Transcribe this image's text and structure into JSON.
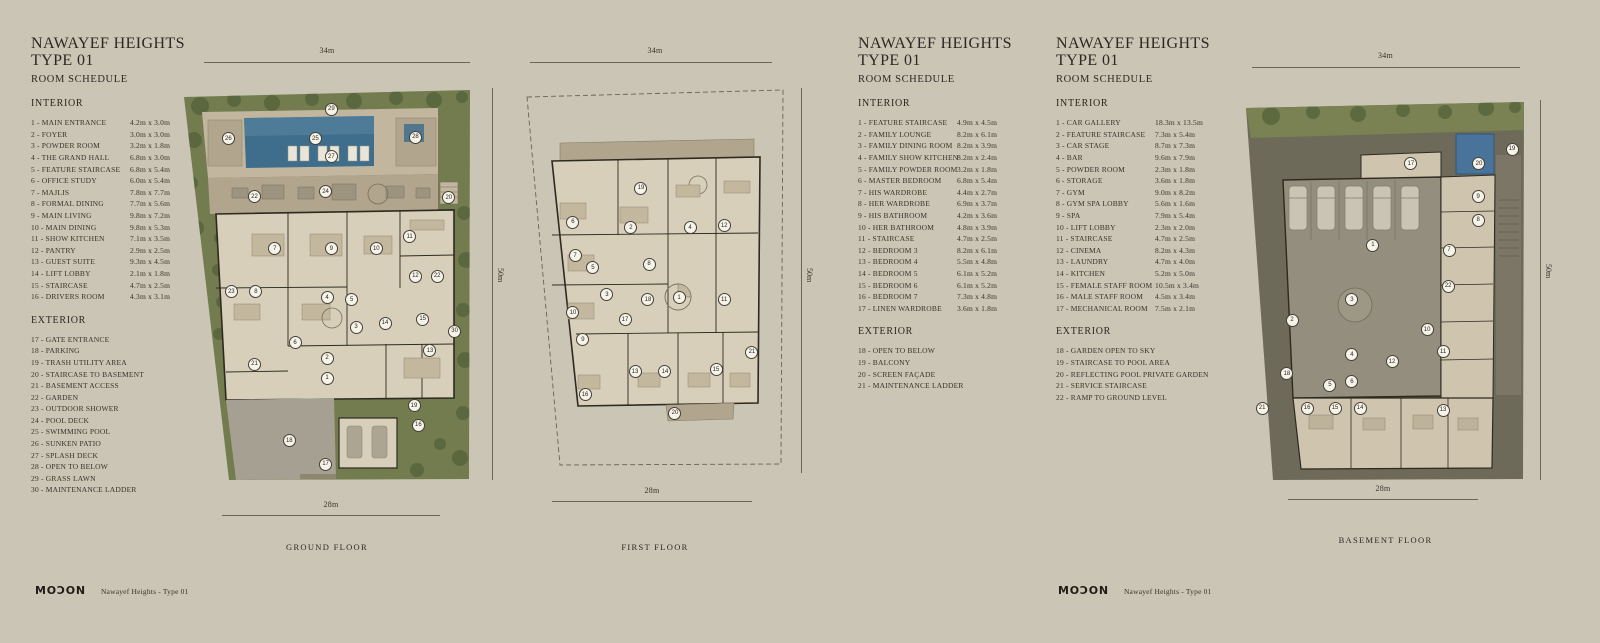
{
  "colors": {
    "bg": "#cbc5b6",
    "ink": "#38332a",
    "land": "#727c4f",
    "tree": "#5a673e",
    "pool": "#3f6e8d",
    "deck": "#c2b69e",
    "terrace": "#b1a58d",
    "floor": "#d8cfba",
    "wall": "#2e2a21",
    "drive": "#a6a092",
    "earth": "#6e6a59",
    "roomtan": "#cfc5ae",
    "paper": "#f6f3e9"
  },
  "sheet_title": {
    "line1": "NAWAYEF HEIGHTS",
    "line2": "TYPE 01",
    "line3": "ROOM SCHEDULE"
  },
  "schedules": [
    {
      "interior_heading": "INTERIOR",
      "exterior_heading": "EXTERIOR",
      "interior": [
        {
          "label": "1 - MAIN ENTRANCE",
          "dim": "4.2m x 3.0m"
        },
        {
          "label": "2 - FOYER",
          "dim": "3.0m x 3.0m"
        },
        {
          "label": "3 - POWDER ROOM",
          "dim": "3.2m x 1.8m"
        },
        {
          "label": "4 - THE GRAND HALL",
          "dim": "6.8m x 3.0m"
        },
        {
          "label": "5 - FEATURE STAIRCASE",
          "dim": "6.8m x 5.4m"
        },
        {
          "label": "6 - OFFICE STUDY",
          "dim": "6.0m x 5.4m"
        },
        {
          "label": "7 - MAJLIS",
          "dim": "7.8m x 7.7m"
        },
        {
          "label": "8 - FORMAL DINING",
          "dim": "7.7m x 5.6m"
        },
        {
          "label": "9 - MAIN LIVING",
          "dim": "9.8m x 7.2m"
        },
        {
          "label": "10 - MAIN DINING",
          "dim": "9.8m x 5.3m"
        },
        {
          "label": "11 - SHOW KITCHEN",
          "dim": "7.1m x 3.5m"
        },
        {
          "label": "12 - PANTRY",
          "dim": "2.9m x 2.5m"
        },
        {
          "label": "13 - GUEST SUITE",
          "dim": "9.3m x 4.5m"
        },
        {
          "label": "14 - LIFT LOBBY",
          "dim": "2.1m x 1.8m"
        },
        {
          "label": "15 - STAIRCASE",
          "dim": "4.7m x 2.5m"
        },
        {
          "label": "16 - DRIVERS ROOM",
          "dim": "4.3m x 3.1m"
        }
      ],
      "exterior": [
        {
          "label": "17 - GATE ENTRANCE"
        },
        {
          "label": "18 - PARKING"
        },
        {
          "label": "19 - TRASH UTILITY AREA"
        },
        {
          "label": "20 - STAIRCASE TO BASEMENT"
        },
        {
          "label": "21 - BASEMENT ACCESS"
        },
        {
          "label": "22 - GARDEN"
        },
        {
          "label": "23 - OUTDOOR SHOWER"
        },
        {
          "label": "24 - POOL DECK"
        },
        {
          "label": "25 - SWIMMING POOL"
        },
        {
          "label": "26 - SUNKEN PATIO"
        },
        {
          "label": "27 - SPLASH DECK"
        },
        {
          "label": "28 - OPEN TO BELOW"
        },
        {
          "label": "29 - GRASS LAWN"
        },
        {
          "label": "30 - MAINTENANCE LADDER"
        }
      ]
    },
    {
      "interior_heading": "INTERIOR",
      "exterior_heading": "EXTERIOR",
      "interior": [
        {
          "label": "1 - FEATURE STAIRCASE",
          "dim": "4.9m x 4.5m"
        },
        {
          "label": "2 - FAMILY LOUNGE",
          "dim": "8.2m x 6.1m"
        },
        {
          "label": "3 - FAMILY DINING ROOM",
          "dim": "8.2m x 3.9m"
        },
        {
          "label": "4 - FAMILY SHOW KITCHEN",
          "dim": "8.2m x 2.4m"
        },
        {
          "label": "5 - FAMILY POWDER ROOM",
          "dim": "3.2m x 1.8m"
        },
        {
          "label": "6 - MASTER BEDROOM",
          "dim": "6.8m x 5.4m"
        },
        {
          "label": "7 - HIS WARDROBE",
          "dim": "4.4m x 2.7m"
        },
        {
          "label": "8 - HER WARDROBE",
          "dim": "6.9m x 3.7m"
        },
        {
          "label": "9 - HIS BATHROOM",
          "dim": "4.2m x 3.6m"
        },
        {
          "label": "10 - HER BATHROOM",
          "dim": "4.8m x 3.9m"
        },
        {
          "label": "11 - STAIRCASE",
          "dim": "4.7m x 2.5m"
        },
        {
          "label": "12 - BEDROOM 3",
          "dim": "8.2m x 6.1m"
        },
        {
          "label": "13 - BEDROOM 4",
          "dim": "5.5m x 4.8m"
        },
        {
          "label": "14 - BEDROOM 5",
          "dim": "6.1m x 5.2m"
        },
        {
          "label": "15 - BEDROOM 6",
          "dim": "6.1m x 5.2m"
        },
        {
          "label": "16 - BEDROOM 7",
          "dim": "7.3m x 4.8m"
        },
        {
          "label": "17 - LINEN WARDROBE",
          "dim": "3.6m x 1.8m"
        }
      ],
      "exterior": [
        {
          "label": "18 - OPEN TO BELOW"
        },
        {
          "label": "19 - BALCONY"
        },
        {
          "label": "20 - SCREEN FAÇADE"
        },
        {
          "label": "21 - MAINTENANCE LADDER"
        }
      ]
    },
    {
      "interior_heading": "INTERIOR",
      "exterior_heading": "EXTERIOR",
      "interior": [
        {
          "label": "1 - CAR GALLERY",
          "dim": "18.3m x 13.5m"
        },
        {
          "label": "2 - FEATURE STAIRCASE",
          "dim": "7.3m x 5.4m"
        },
        {
          "label": "3 - CAR STAGE",
          "dim": "8.7m x 7.3m"
        },
        {
          "label": "4 - BAR",
          "dim": "9.6m x 7.9m"
        },
        {
          "label": "5 - POWDER ROOM",
          "dim": "2.3m x 1.8m"
        },
        {
          "label": "6 - STORAGE",
          "dim": "3.6m x 1.8m"
        },
        {
          "label": "7 - GYM",
          "dim": "9.0m x 8.2m"
        },
        {
          "label": "8 - GYM SPA LOBBY",
          "dim": "5.6m x 1.6m"
        },
        {
          "label": "9 - SPA",
          "dim": "7.9m x 5.4m"
        },
        {
          "label": "10 - LIFT LOBBY",
          "dim": "2.3m x 2.0m"
        },
        {
          "label": "11 - STAIRCASE",
          "dim": "4.7m x 2.5m"
        },
        {
          "label": "12 - CINEMA",
          "dim": "8.2m x 4.3m"
        },
        {
          "label": "13 - LAUNDRY",
          "dim": "4.7m x 4.0m"
        },
        {
          "label": "14 - KITCHEN",
          "dim": "5.2m x 5.0m"
        },
        {
          "label": "15 - FEMALE STAFF ROOM",
          "dim": "10.5m x 3.4m"
        },
        {
          "label": "16 - MALE STAFF ROOM",
          "dim": "4.5m x 3.4m"
        },
        {
          "label": "17 - MECHANICAL ROOM",
          "dim": "7.5m x 2.1m"
        }
      ],
      "exterior": [
        {
          "label": "18 - GARDEN OPEN TO SKY"
        },
        {
          "label": "19 - STAIRCASE TO POOL AREA"
        },
        {
          "label": "20 - REFLECTING POOL PRIVATE GARDEN"
        },
        {
          "label": "21 - SERVICE STAIRCASE"
        },
        {
          "label": "22 - RAMP TO GROUND LEVEL"
        }
      ]
    }
  ],
  "plans": [
    {
      "caption": "GROUND FLOOR",
      "dim_top": "34m",
      "dim_bottom": "28m",
      "dim_right": "50m",
      "markers": [
        {
          "n": 29,
          "x": 51.5,
          "y": 5.4
        },
        {
          "n": 26,
          "x": 16,
          "y": 13
        },
        {
          "n": 25,
          "x": 46,
          "y": 13
        },
        {
          "n": 27,
          "x": 51.5,
          "y": 17.6
        },
        {
          "n": 28,
          "x": 80.5,
          "y": 12.5
        },
        {
          "n": 22,
          "x": 25,
          "y": 27.8
        },
        {
          "n": 24,
          "x": 49.5,
          "y": 26.5
        },
        {
          "n": 20,
          "x": 92,
          "y": 28
        },
        {
          "n": 7,
          "x": 32,
          "y": 41
        },
        {
          "n": 9,
          "x": 51.5,
          "y": 41
        },
        {
          "n": 10,
          "x": 67,
          "y": 41
        },
        {
          "n": 11,
          "x": 78.5,
          "y": 38
        },
        {
          "n": 12,
          "x": 80.5,
          "y": 48
        },
        {
          "n": 22,
          "x": 88,
          "y": 48
        },
        {
          "n": 23,
          "x": 17,
          "y": 52
        },
        {
          "n": 8,
          "x": 25.5,
          "y": 52
        },
        {
          "n": 4,
          "x": 50,
          "y": 53.5
        },
        {
          "n": 5,
          "x": 58.5,
          "y": 54
        },
        {
          "n": 15,
          "x": 83,
          "y": 59
        },
        {
          "n": 3,
          "x": 60,
          "y": 61
        },
        {
          "n": 14,
          "x": 70,
          "y": 60
        },
        {
          "n": 6,
          "x": 39,
          "y": 65
        },
        {
          "n": 13,
          "x": 85.5,
          "y": 67
        },
        {
          "n": 2,
          "x": 50,
          "y": 69
        },
        {
          "n": 21,
          "x": 25,
          "y": 70.5
        },
        {
          "n": 30,
          "x": 94,
          "y": 62
        },
        {
          "n": 1,
          "x": 50,
          "y": 74
        },
        {
          "n": 19,
          "x": 80,
          "y": 81
        },
        {
          "n": 16,
          "x": 81.5,
          "y": 86
        },
        {
          "n": 18,
          "x": 37,
          "y": 90
        },
        {
          "n": 17,
          "x": 49.5,
          "y": 96
        }
      ]
    },
    {
      "caption": "FIRST FLOOR",
      "dim_top": "34m",
      "dim_bottom": "28m",
      "dim_right": "50m",
      "markers": [
        {
          "n": 19,
          "x": 44.8,
          "y": 26.8
        },
        {
          "n": 6,
          "x": 19.6,
          "y": 35.6
        },
        {
          "n": 2,
          "x": 41.1,
          "y": 37.1
        },
        {
          "n": 4,
          "x": 63,
          "y": 37.1
        },
        {
          "n": 12,
          "x": 75.6,
          "y": 36.6
        },
        {
          "n": 7,
          "x": 20.4,
          "y": 44.4
        },
        {
          "n": 5,
          "x": 27,
          "y": 47.5
        },
        {
          "n": 8,
          "x": 47.8,
          "y": 46.5
        },
        {
          "n": 3,
          "x": 32.2,
          "y": 54.5
        },
        {
          "n": 18,
          "x": 47.4,
          "y": 55.8
        },
        {
          "n": 1,
          "x": 58.9,
          "y": 55.3
        },
        {
          "n": 11,
          "x": 75.6,
          "y": 55.8
        },
        {
          "n": 10,
          "x": 19.6,
          "y": 59.2
        },
        {
          "n": 17,
          "x": 38.9,
          "y": 61
        },
        {
          "n": 9,
          "x": 23.3,
          "y": 66.2
        },
        {
          "n": 21,
          "x": 85.9,
          "y": 69.4
        },
        {
          "n": 13,
          "x": 42.6,
          "y": 74.5
        },
        {
          "n": 14,
          "x": 53.7,
          "y": 74.5
        },
        {
          "n": 15,
          "x": 72.6,
          "y": 74
        },
        {
          "n": 16,
          "x": 24.1,
          "y": 80.5
        },
        {
          "n": 20,
          "x": 57.4,
          "y": 85.2
        }
      ]
    },
    {
      "caption": "BASEMENT FLOOR",
      "dim_top": "34m",
      "dim_bottom": "28m",
      "dim_right": "50m",
      "markers": [
        {
          "n": 19,
          "x": 94.4,
          "y": 12.9
        },
        {
          "n": 17,
          "x": 58.9,
          "y": 16.8
        },
        {
          "n": 20,
          "x": 82.8,
          "y": 16.8
        },
        {
          "n": 9,
          "x": 82.5,
          "y": 25.5
        },
        {
          "n": 8,
          "x": 82.5,
          "y": 31.6
        },
        {
          "n": 1,
          "x": 45.6,
          "y": 38.2
        },
        {
          "n": 7,
          "x": 72.3,
          "y": 39.5
        },
        {
          "n": 22,
          "x": 72,
          "y": 49
        },
        {
          "n": 3,
          "x": 38.2,
          "y": 52.6
        },
        {
          "n": 2,
          "x": 17.2,
          "y": 57.9
        },
        {
          "n": 10,
          "x": 64.6,
          "y": 60.5
        },
        {
          "n": 11,
          "x": 70.2,
          "y": 66.3
        },
        {
          "n": 4,
          "x": 38.2,
          "y": 67.1
        },
        {
          "n": 12,
          "x": 52.3,
          "y": 68.9
        },
        {
          "n": 18,
          "x": 15.4,
          "y": 72
        },
        {
          "n": 6,
          "x": 38.2,
          "y": 74.2
        },
        {
          "n": 5,
          "x": 30.5,
          "y": 75
        },
        {
          "n": 21,
          "x": 6.7,
          "y": 81.1
        },
        {
          "n": 16,
          "x": 22.5,
          "y": 81.1
        },
        {
          "n": 15,
          "x": 32.3,
          "y": 81.1
        },
        {
          "n": 14,
          "x": 41.1,
          "y": 81.1
        },
        {
          "n": 13,
          "x": 70.2,
          "y": 81.6
        }
      ]
    }
  ],
  "footer": {
    "brand": "MOƆON",
    "label": "Nawayef Heights - Type 01"
  }
}
